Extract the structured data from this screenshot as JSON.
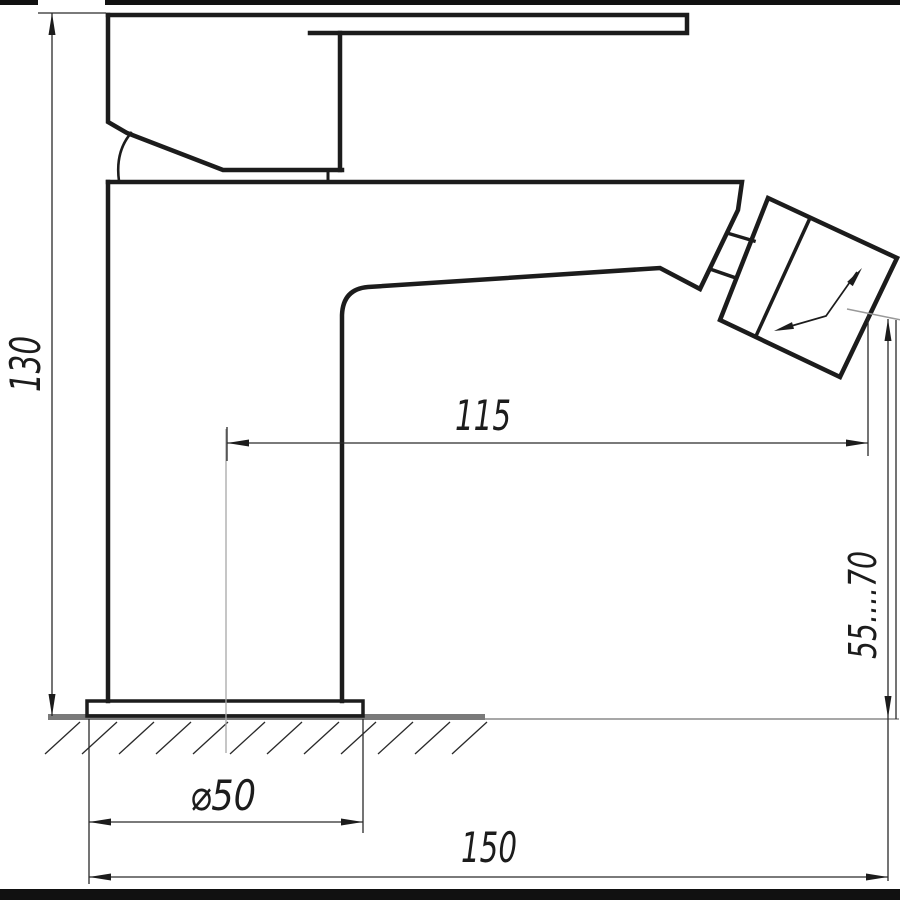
{
  "drawing": {
    "labels": {
      "height_total": "130",
      "spout_reach": "115",
      "outlet_height": "55....70",
      "base_diameter": "⌀50",
      "length_total": "150"
    },
    "colors": {
      "line": "#1c1c1c",
      "ground_gray": "#7a7a7a",
      "aux_gray": "#999999",
      "background": "#ffffff"
    }
  }
}
